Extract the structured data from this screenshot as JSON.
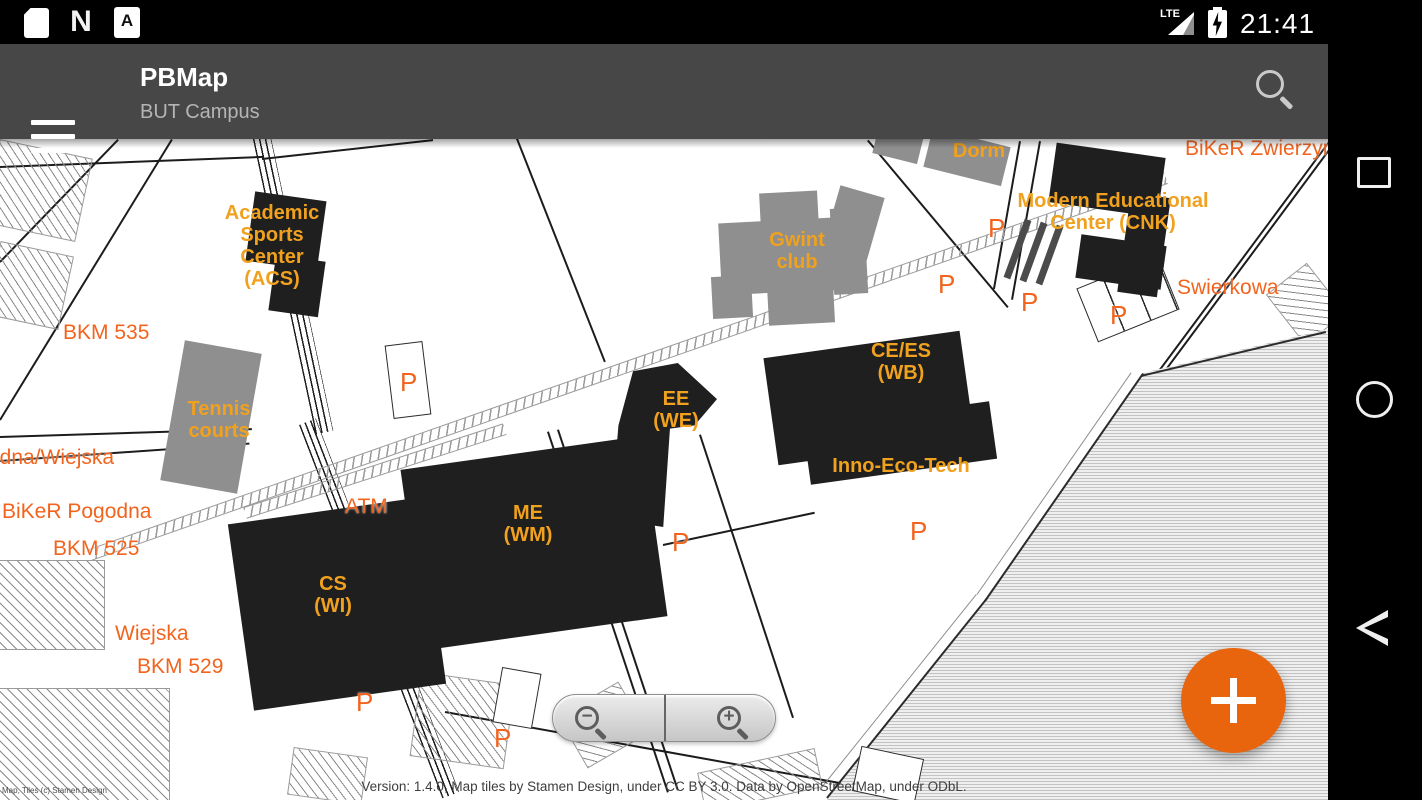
{
  "colors": {
    "accent_orange": "#E8650D",
    "building_label_amber": "#F0A11E",
    "street_label_orange": "#F2641E",
    "building_fill": "#1F1F1F",
    "building_gray": "#8F8F8F",
    "toolbar_gray": "#474747"
  },
  "status_bar": {
    "time": "21:41",
    "network": "LTE",
    "icons": [
      {
        "name": "sd-card-icon"
      },
      {
        "name": "android-n-icon",
        "glyph": "N"
      },
      {
        "name": "file-a-icon",
        "glyph": "A"
      },
      {
        "name": "signal-icon"
      },
      {
        "name": "battery-charging-icon"
      }
    ]
  },
  "toolbar": {
    "title": "PBMap",
    "subtitle": "BUT Campus",
    "icons": [
      {
        "name": "menu-icon"
      },
      {
        "name": "search-icon"
      }
    ]
  },
  "nav_bar": {
    "icons": [
      {
        "name": "recents-square-icon"
      },
      {
        "name": "home-circle-icon"
      },
      {
        "name": "back-triangle-icon"
      }
    ]
  },
  "map": {
    "building_labels": {
      "acs": "Academic\nSports\nCenter\n(ACS)",
      "tennis": "Tennis\ncourts",
      "gwint": "Gwint\nclub",
      "dorm_upper": "Dorm",
      "dorm_lower": "Dorm",
      "cnk": "Modern Educational\nCenter (CNK)",
      "ce_es": "CE/ES\n(WB)",
      "inno": "Inno-Eco-Tech",
      "ee": "EE\n(WE)",
      "me": "ME\n(WM)",
      "cs": "CS\n(WI)"
    },
    "street_labels": {
      "bkm535": "BKM 535",
      "pogodna_wiejska": "odna/Wiejska",
      "biker_pogodna": "BiKeR Pogodna",
      "bkm525": "BKM 525",
      "wiejska": "Wiejska",
      "bkm529": "BKM 529",
      "swierkowa": "Swierkowa",
      "biker_zwierzyniecka": "BiKeR Zwierzyn",
      "atm": "ATM"
    },
    "parking_label": "P",
    "zoom_control": {
      "zoom_out": "−",
      "zoom_in": "+"
    },
    "attribution": "Version: 1.4.0, Map tiles by Stamen Design, under CC BY 3.0. Data by OpenStreetMap, under ODbL.",
    "corner_attribution": "Map, Tiles (c) Stamen Design"
  },
  "fab": {
    "icon": "plus-icon"
  }
}
